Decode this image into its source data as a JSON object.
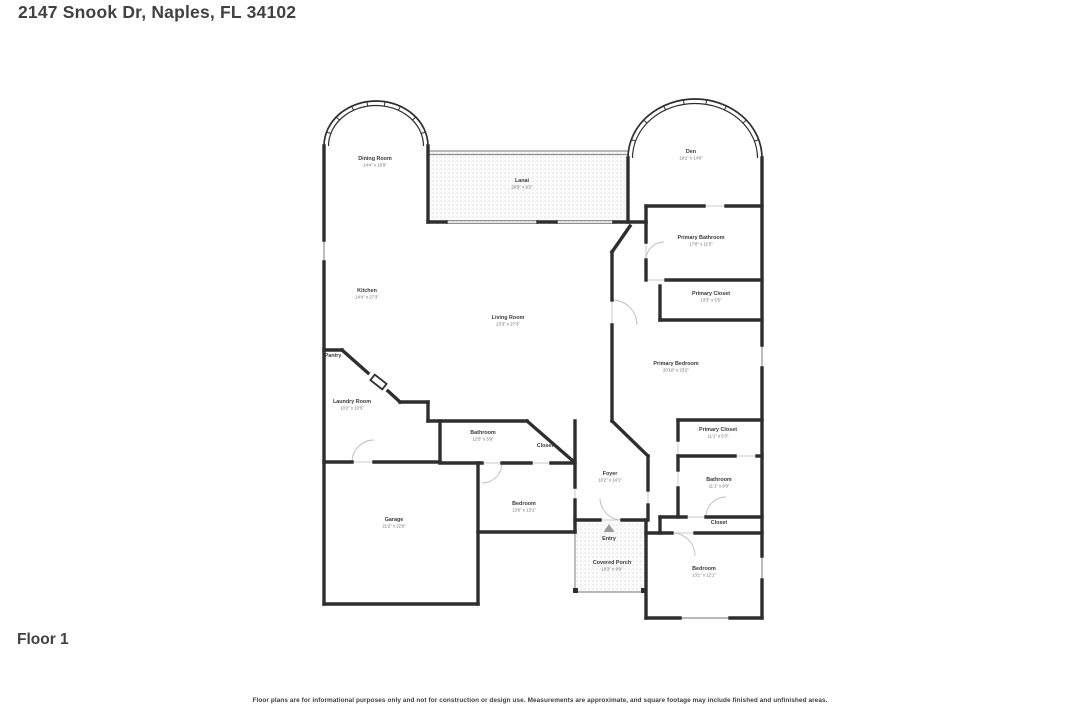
{
  "page": {
    "title": "2147 Snook Dr, Naples, FL 34102",
    "floor_label": "Floor 1",
    "disclaimer": "Floor plans are for informational purposes only and not for construction or design use. Measurements are approximate, and square footage may include finished and unfinished areas."
  },
  "floor_plan": {
    "colors": {
      "wall": "#2e2e2e",
      "window": "#8f8f8f",
      "gap": "#c9c9c9",
      "swing": "#bdbdbd",
      "hatch_bg": "#fafafa",
      "entry_arrow": "#9c9c9c"
    },
    "entry_marker": {
      "label": "Entry",
      "icon": "up-triangle-icon",
      "x": 609,
      "y": 540
    },
    "rooms": [
      {
        "name": "Dining Room",
        "dims": "14'4\" x 16'9\"",
        "x": 375,
        "y": 160
      },
      {
        "name": "Lanai",
        "dims": "26'9\" x 9'2\"",
        "x": 522,
        "y": 182
      },
      {
        "name": "Den",
        "dims": "19'2\" x 14'6\"",
        "x": 691,
        "y": 153
      },
      {
        "name": "Primary Bathroom",
        "dims": "17'8\" x 11'5\"",
        "x": 701,
        "y": 239
      },
      {
        "name": "Primary Closet",
        "dims": "13'3\" x 5'5\"",
        "x": 711,
        "y": 295
      },
      {
        "name": "Kitchen",
        "dims": "14'4\" x 27'3\"",
        "x": 367,
        "y": 292
      },
      {
        "name": "Living Room",
        "dims": "23'3\" x 27'3\"",
        "x": 508,
        "y": 319
      },
      {
        "name": "Pantry",
        "dims": "",
        "x": 333,
        "y": 357
      },
      {
        "name": "Laundry Room",
        "dims": "10'2\" x 10'5\"",
        "x": 352,
        "y": 403
      },
      {
        "name": "Primary Bedroom",
        "dims": "20'10\" x 23'2\"",
        "x": 676,
        "y": 365
      },
      {
        "name": "Primary Closet",
        "dims": "11'1\" x 5'3\"",
        "x": 718,
        "y": 431
      },
      {
        "name": "Bathroom",
        "dims": "12'5\" x 5'9\"",
        "x": 483,
        "y": 434
      },
      {
        "name": "Closet",
        "dims": "",
        "x": 545,
        "y": 447
      },
      {
        "name": "Foyer",
        "dims": "10'2\" x 14'1\"",
        "x": 610,
        "y": 475
      },
      {
        "name": "Bathroom",
        "dims": "11'1\" x 9'9\"",
        "x": 719,
        "y": 481
      },
      {
        "name": "Bedroom",
        "dims": "13'6\" x 13'1\"",
        "x": 524,
        "y": 505
      },
      {
        "name": "Garage",
        "dims": "21'2\" x 22'6\"",
        "x": 394,
        "y": 521
      },
      {
        "name": "Closet",
        "dims": "",
        "x": 719,
        "y": 524
      },
      {
        "name": "Entry",
        "dims": "",
        "x": 609,
        "y": 540
      },
      {
        "name": "Covered Porch",
        "dims": "10'2\" x 9'9\"",
        "x": 612,
        "y": 564
      },
      {
        "name": "Bedroom",
        "dims": "13'1\" x 12'1\"",
        "x": 704,
        "y": 570
      }
    ]
  }
}
